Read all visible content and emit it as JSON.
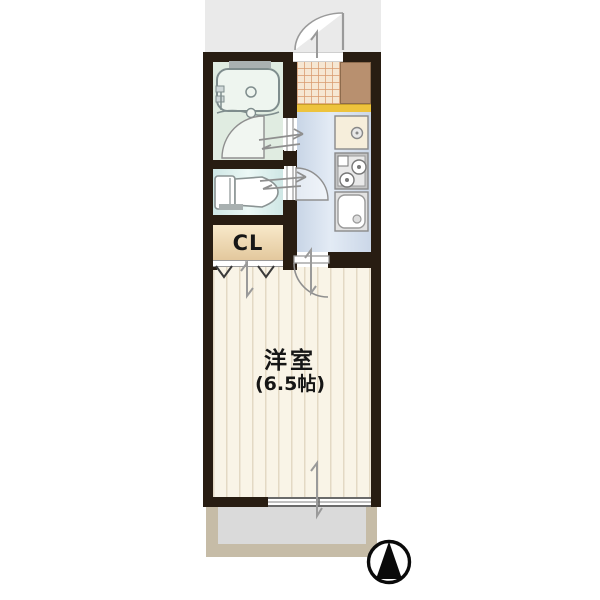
{
  "title": "apartment-floorplan",
  "labels": {
    "closet": "CL",
    "main_room": "洋室",
    "main_room_size": "(6.5帖)"
  },
  "rooms": [
    {
      "name": "bathroom"
    },
    {
      "name": "toilet"
    },
    {
      "name": "closet",
      "label": "CL"
    },
    {
      "name": "entrance-genkan"
    },
    {
      "name": "kitchen"
    },
    {
      "name": "western-room",
      "label": "洋室",
      "size": "(6.5帖)"
    },
    {
      "name": "balcony"
    }
  ],
  "compass": {
    "direction": "north"
  },
  "colors": {
    "wall": "#281d12",
    "room_floor": "#f9f4e7",
    "kitchen_floor": "#cdd9e9",
    "bath_floor": "#e0ece1",
    "toilet_floor": "#daeeec",
    "closet_floor": "#f2dfbe",
    "genkan_step": "#edc33d",
    "balcony_frame": "#c6bca7",
    "balcony_floor": "#dadada",
    "cabinet": "#b8906f",
    "bg_top": "#eaeaea"
  }
}
